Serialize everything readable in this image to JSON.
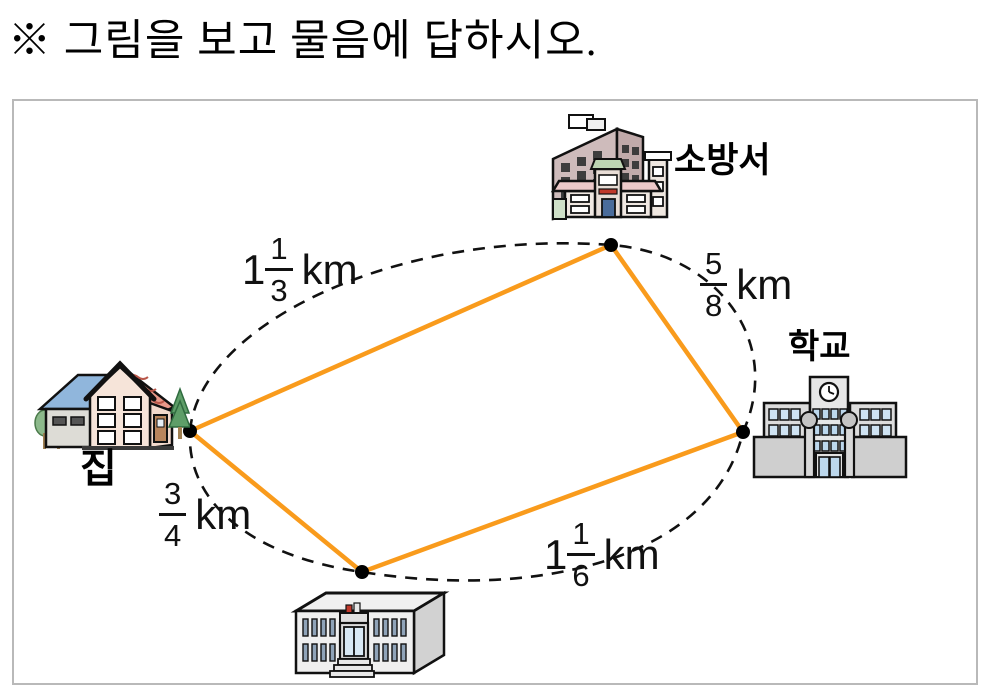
{
  "heading": "※ 그림을 보고 물음에 답하시오.",
  "diagram": {
    "labels": {
      "house": "집",
      "fire_station": "소방서",
      "school": "학교"
    },
    "distances": {
      "house_fire": {
        "from": "집",
        "to": "소방서",
        "whole": "1",
        "num": "1",
        "den": "3",
        "unit": "km",
        "value_text": "1 1/3 km"
      },
      "fire_school": {
        "from": "소방서",
        "to": "학교",
        "whole": "",
        "num": "5",
        "den": "8",
        "unit": "km",
        "value_text": "5/8 km"
      },
      "house_office": {
        "from": "집",
        "to": "공공건물",
        "whole": "",
        "num": "3",
        "den": "4",
        "unit": "km",
        "value_text": "3/4 km"
      },
      "office_school": {
        "from": "공공건물",
        "to": "학교",
        "whole": "1",
        "num": "1",
        "den": "6",
        "unit": "km",
        "value_text": "1 1/6 km"
      }
    },
    "colors": {
      "route": "#f99b1c",
      "dash": "#111111",
      "dot": "#000000",
      "box_border": "#b9b9b9"
    }
  }
}
